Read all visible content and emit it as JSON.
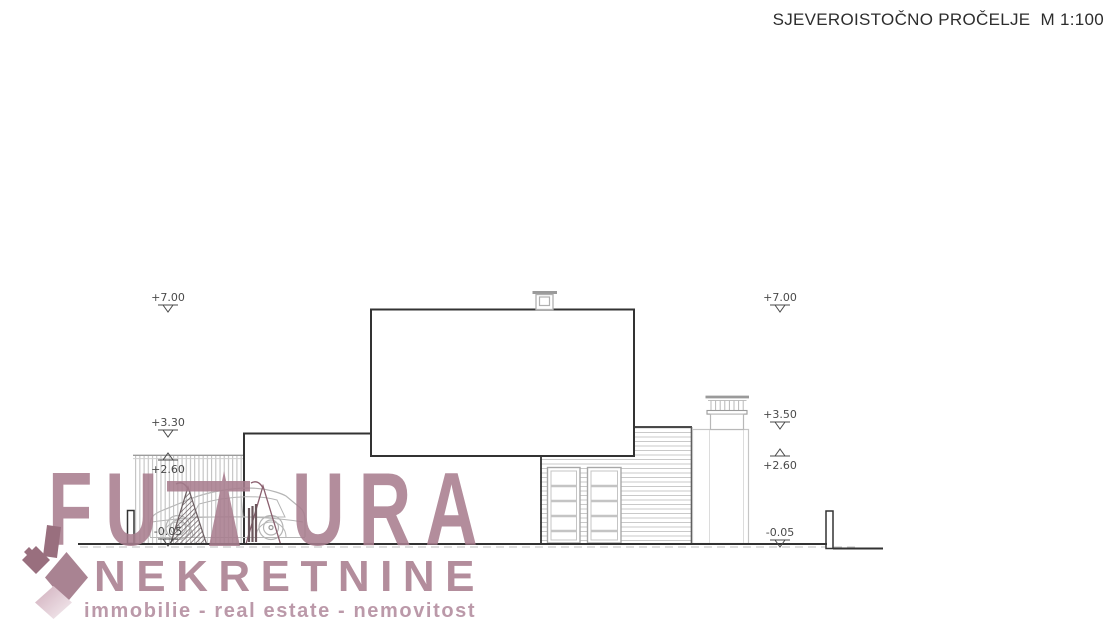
{
  "title": "SJEVEROISTOČNO PROČELJE  M 1:100",
  "drawing": {
    "kind": "architectural elevation",
    "facade_name": "SJEVEROISTOČNO PROČELJE",
    "scale": "M 1:100",
    "levels_left": [
      {
        "value": "+7.00"
      },
      {
        "value": "+3.30"
      },
      {
        "value": "+2.60"
      },
      {
        "value": "-0.05"
      }
    ],
    "levels_right": [
      {
        "value": "+7.00"
      },
      {
        "value": "+3.50"
      },
      {
        "value": "+2.60"
      },
      {
        "value": "-0.05"
      }
    ]
  },
  "watermark": {
    "brand_first": "FU",
    "brand_last": "URA",
    "brand_second_line": "NEKRETNINE",
    "tagline": "immobilie - real estate - nemovitost",
    "colors": {
      "brand": "#a87d8e",
      "tagline": "#b28a9d",
      "logo_dark": "#8a5a6c",
      "logo_mid": "#9d7183",
      "logo_light": "#d4afbd"
    }
  },
  "colors": {
    "line_dark": "#333333",
    "line_light": "#c2c2c2",
    "label_text": "#4a4a4a",
    "background": "#ffffff"
  }
}
